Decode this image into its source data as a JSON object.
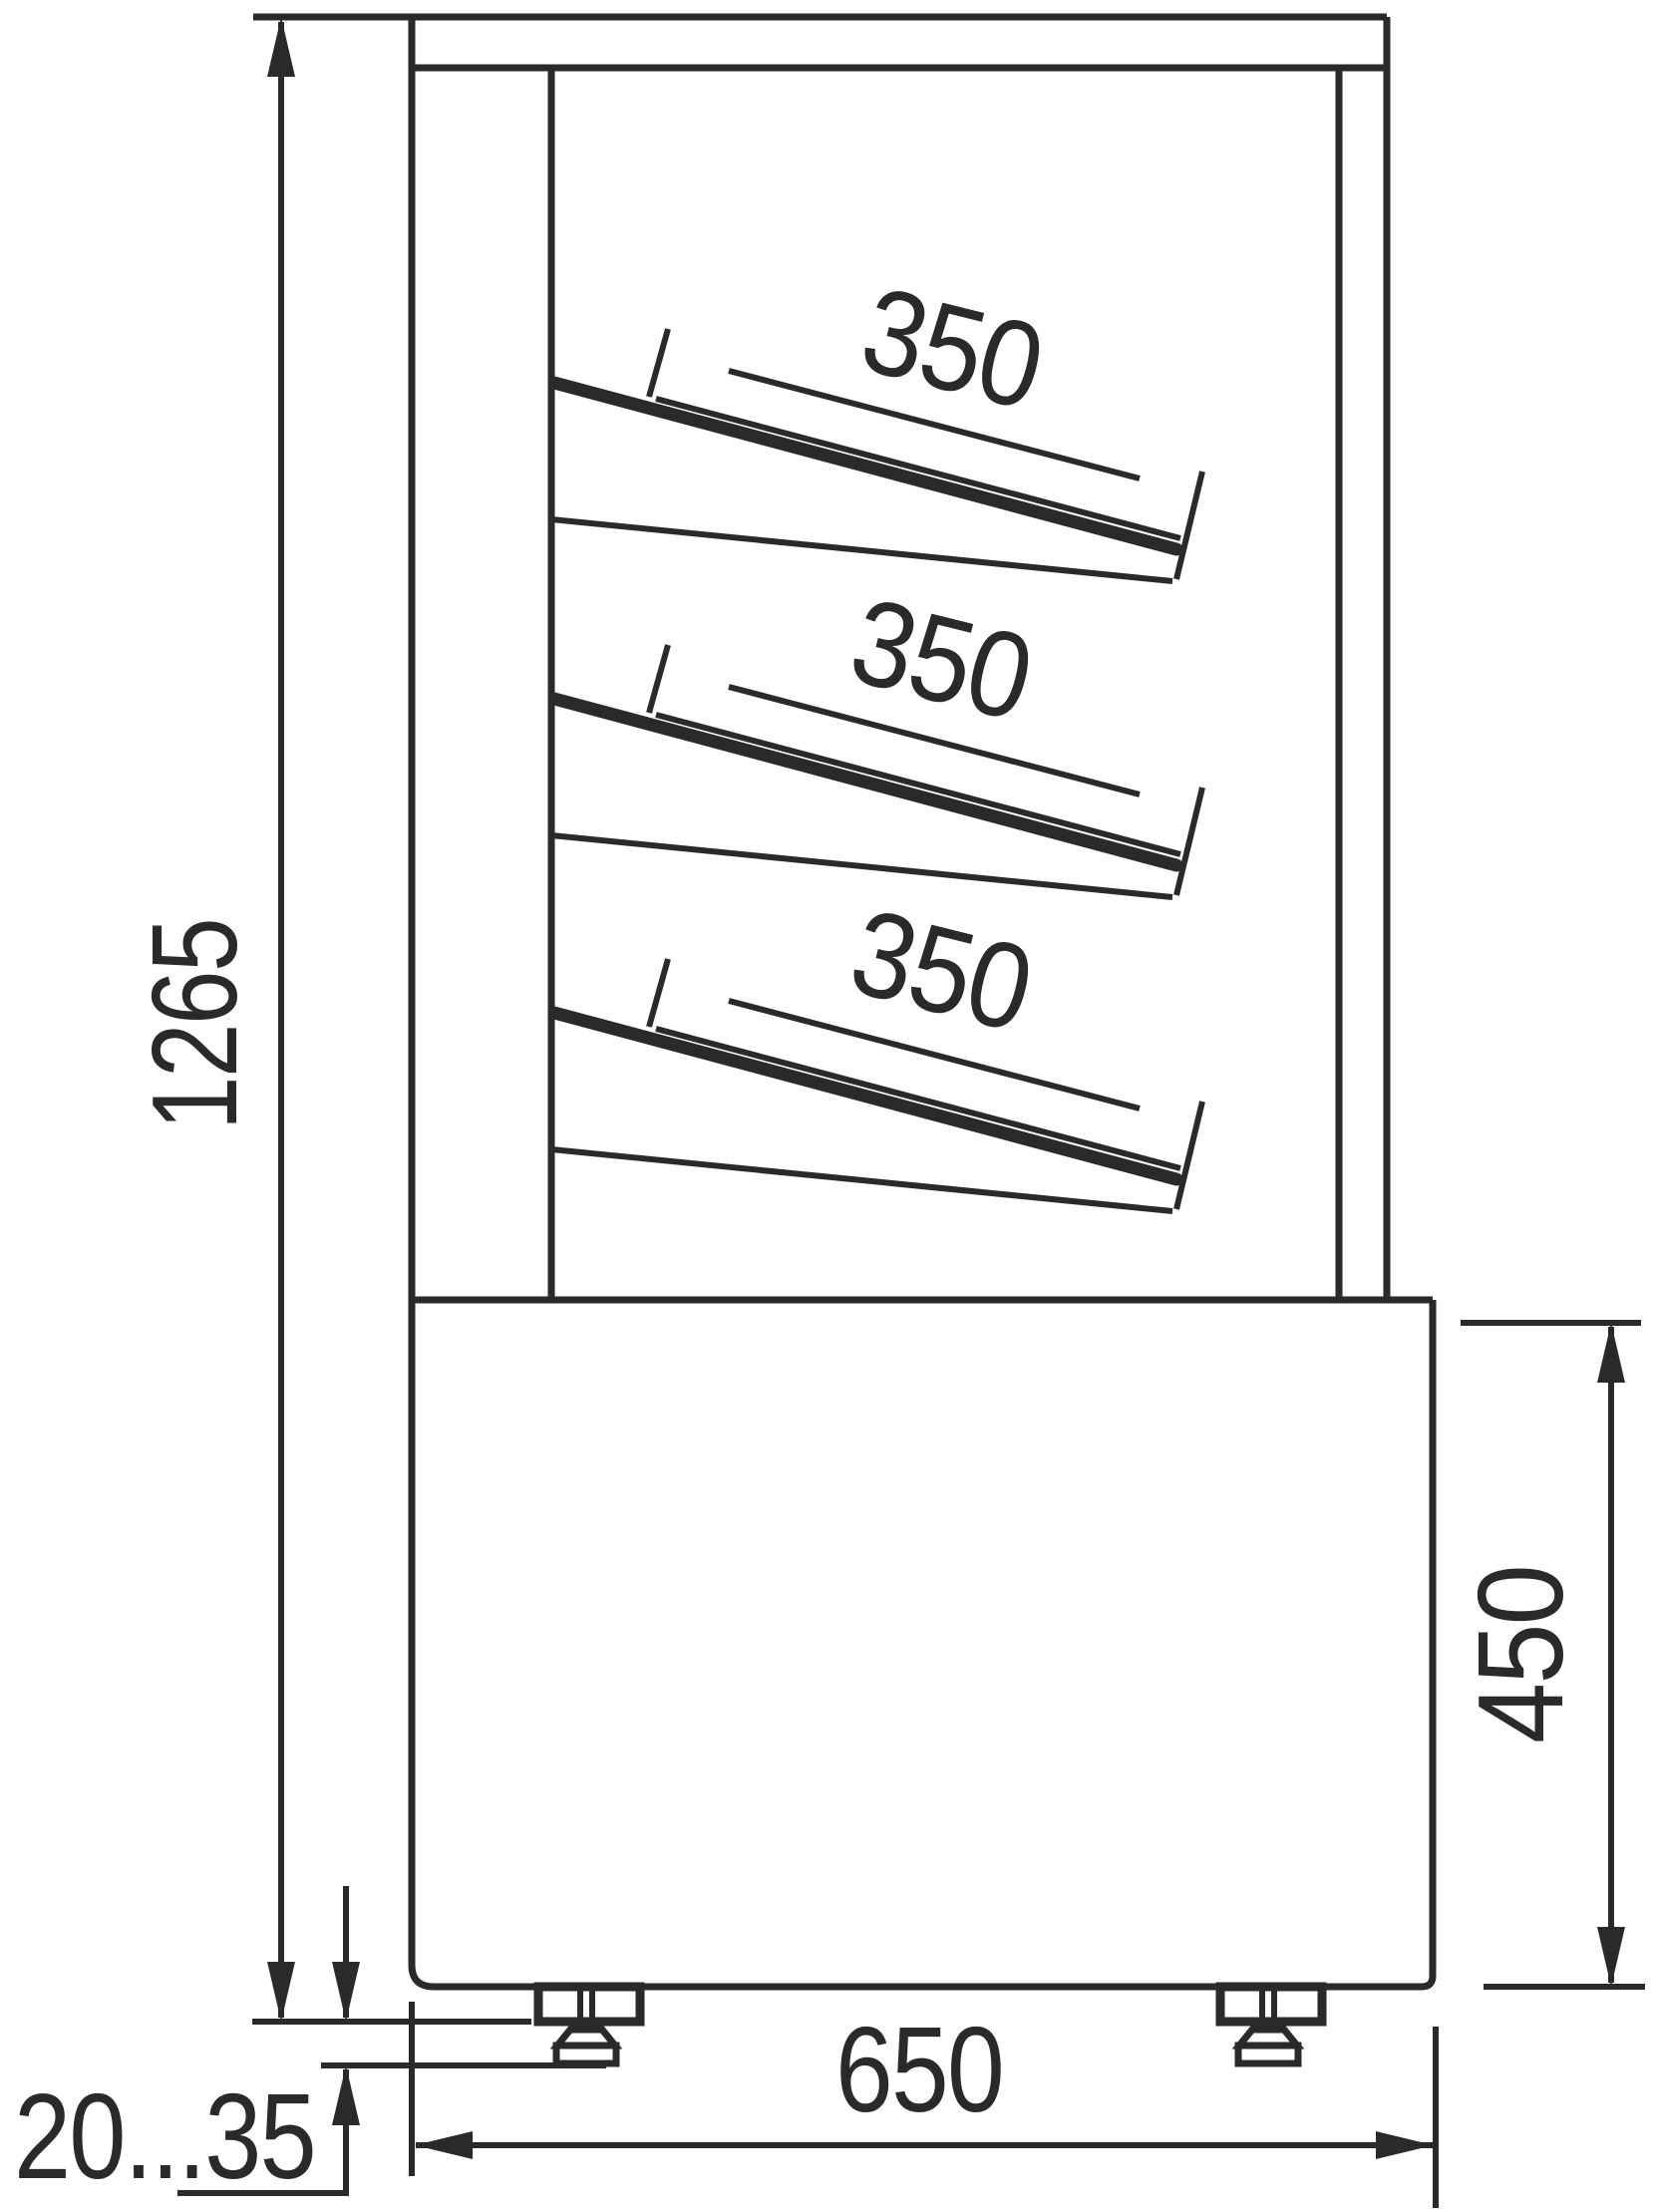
{
  "labels": {
    "overall_height": "1265",
    "shelf1_depth": "350",
    "shelf2_depth": "350",
    "shelf3_depth": "350",
    "base_height": "450",
    "base_depth": "650",
    "feet_adjust_range": "20...35"
  },
  "colors": {
    "line": "#2b2a29",
    "background": "#ffffff"
  }
}
